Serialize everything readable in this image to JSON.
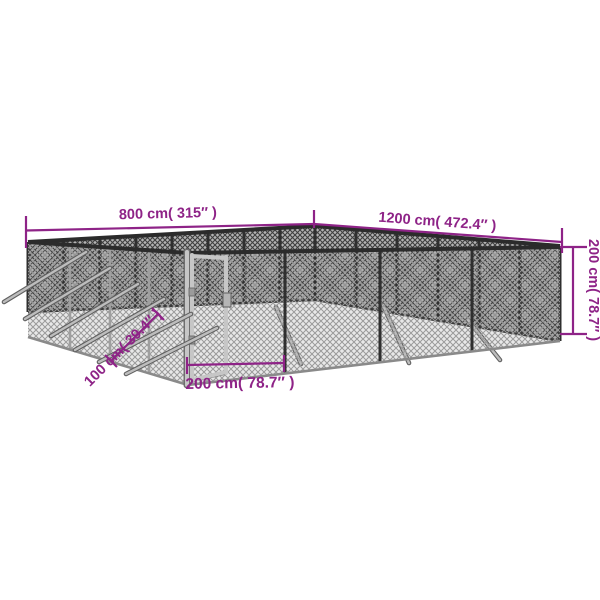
{
  "diagram": {
    "type": "product-dimension-diagram",
    "subject": "outdoor-chain-link-kennel",
    "dimensions": {
      "back_left_width": "800 cm( 315″ )",
      "back_right_width": "1200 cm( 472.4″ )",
      "height": "200 cm( 78.7″ )",
      "panel_width": "100 cm( 39.4″ )",
      "gate_panel_width": "200 cm( 78.7″ )"
    },
    "colors": {
      "dimension_annotation": "#8e2387",
      "frame_rail": "#2b2b2b",
      "mesh_dark_line": "#3f3f3f",
      "mesh_dark_background": "#b3b3b3",
      "mesh_light_line": "#9a9a9a",
      "post_silver": "#c6c6c6",
      "stake_gray": "#bdbdbd",
      "ground_shadow": "#d6d6d6",
      "background": "#ffffff"
    }
  }
}
